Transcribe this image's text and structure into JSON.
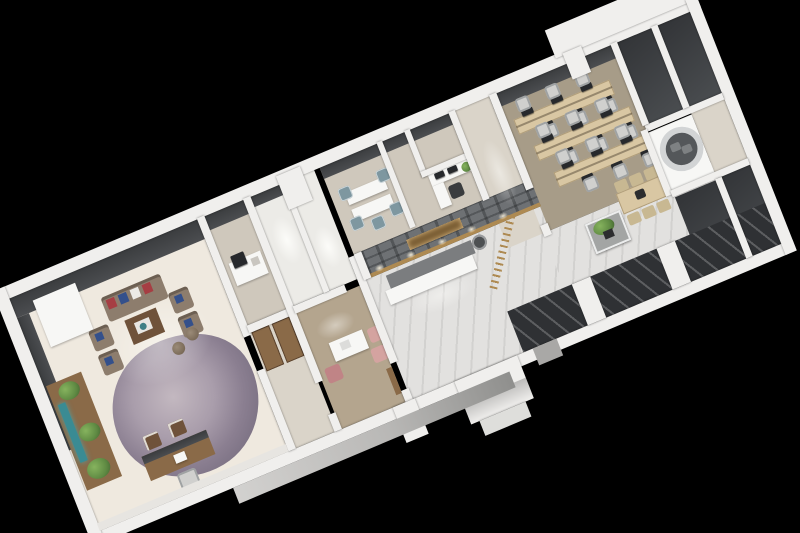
{
  "scene": {
    "type": "3d-isometric-floorplan-render",
    "background": "black",
    "building": "long narrow office suite viewed from above at an angle, long axis running from lower-left to upper-right",
    "rooms": [
      "executive-office-with-lounge",
      "pantry-print-room",
      "corridor-with-wood-doors",
      "consultation-office",
      "restrooms",
      "reception-hall-with-stone-feature-wall",
      "back-offices",
      "manager-office",
      "open-plan-office",
      "break-area-with-island-and-long-table",
      "meeting-room-with-round-window",
      "far-end-dark-rooms"
    ],
    "notable_objects": [
      "taupe sofa set with red and blue pillows",
      "purple-grey area rug",
      "executive wood desk",
      "sideboard with plants and aquarium strip",
      "grey stone reception wall with gold niche and spotlights",
      "white reception counter",
      "gold slat screen",
      "three benching desk rows with monitors",
      "kitchen island with plant",
      "long wood dining table",
      "circular wall opening showing chairs"
    ]
  },
  "palette": {
    "bg": "#000000",
    "wallCap": "#f0efed",
    "wallCapShade": "#dededb",
    "panelDark": "#3a3c3e",
    "panelMid": "#4b4d50",
    "floorCream": "#efe9df",
    "floorTan": "#b4a58e",
    "floorBeige": "#cfc8bc",
    "carpetOffice": "#a79c88",
    "marble": "#e2e1df",
    "stone": "#6e7174",
    "gold": "#ae8a52",
    "woodDark": "#6f523a",
    "woodMid": "#8a6a48",
    "woodLight": "#d9c7a3",
    "sofaTaupe": "#8d7d6d",
    "pillowRed": "#a63e43",
    "pillowBlue": "#34508b",
    "chairPink": "#d4a3a0",
    "chairPinkDark": "#c08486",
    "chairTeal": "#7e97a0",
    "chairGray": "#d0d0ce",
    "monitorDark": "#27292c",
    "rugLight": "#b6aab3",
    "rugDark": "#7c7080",
    "plantGreen": "#5f8a43",
    "plantDark": "#3f5e2e",
    "white": "#f7f7f5",
    "glassDark": "#2f3134",
    "tealGlow": "#3a8b93"
  }
}
